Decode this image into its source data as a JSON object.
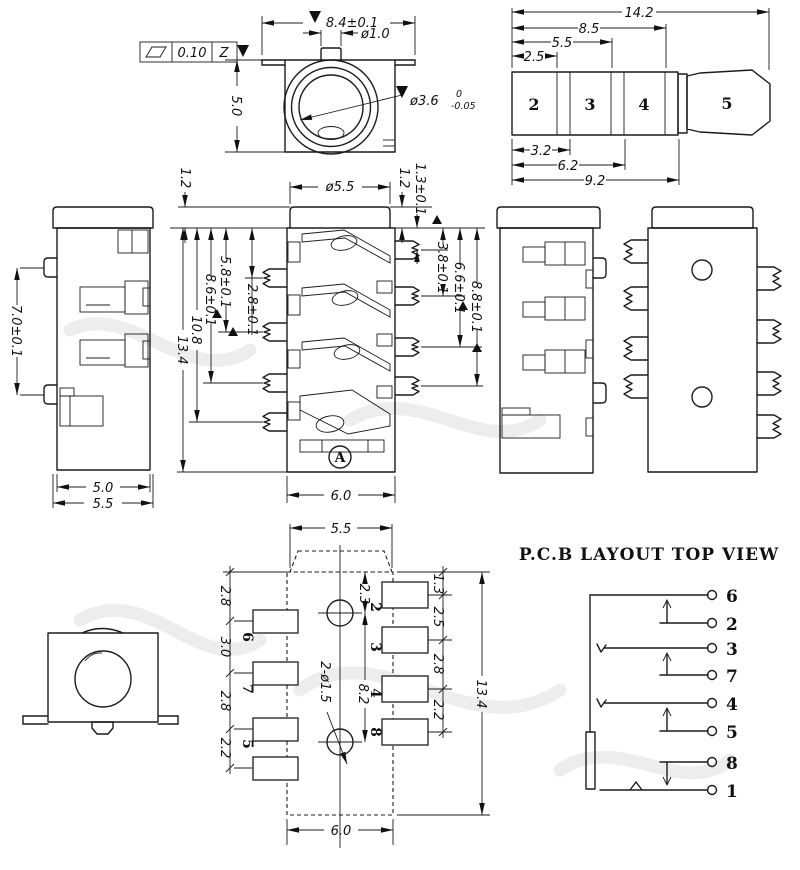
{
  "frame": {
    "val": "0.10",
    "datum": "Z"
  },
  "front": {
    "w": "8.4±0.1",
    "boss": "ø1.0",
    "h": "5.0",
    "bore": "ø3.6",
    "tol_up": "0",
    "tol_dn": "-0.05"
  },
  "plug": {
    "total": "14.2",
    "l85": "8.5",
    "l55": "5.5",
    "l25": "2.5",
    "l32": "3.2",
    "l62": "6.2",
    "l92": "9.2",
    "seg": [
      "2",
      "3",
      "4",
      "5"
    ]
  },
  "side": {
    "pitch": "7.0±0.1",
    "w50": "5.0",
    "w55": "5.5"
  },
  "section": {
    "cap_l": "1.2",
    "cap_dia": "ø5.5",
    "cap_r": "1.2",
    "cap_r2": "1.3±0.1",
    "left": [
      "13.4",
      "10.8",
      "8.6±0.1",
      "5.8±0.1",
      "2.8±0.1"
    ],
    "right": [
      "3.8±0.1",
      "6.6±0.1",
      "8.8±0.1"
    ],
    "bottom": "6.0",
    "datum": "A"
  },
  "pcb": {
    "top": "5.5",
    "left": [
      "2.8",
      "3.0",
      "2.8",
      "2.2"
    ],
    "right": [
      "1.3",
      "2.5",
      "2.8",
      "2.2"
    ],
    "total": "13.4",
    "h1": "2.3",
    "h2": "8.2",
    "holes": "2-ø1.5",
    "bottom": "6.0",
    "pads_left": [
      "6",
      "7",
      "5"
    ],
    "pads_right": [
      "2",
      "3",
      "4",
      "8"
    ]
  },
  "schematic": {
    "title": "P.C.B LAYOUT TOP VIEW",
    "pins": [
      "6",
      "2",
      "3",
      "7",
      "4",
      "5",
      "8",
      "1"
    ]
  }
}
